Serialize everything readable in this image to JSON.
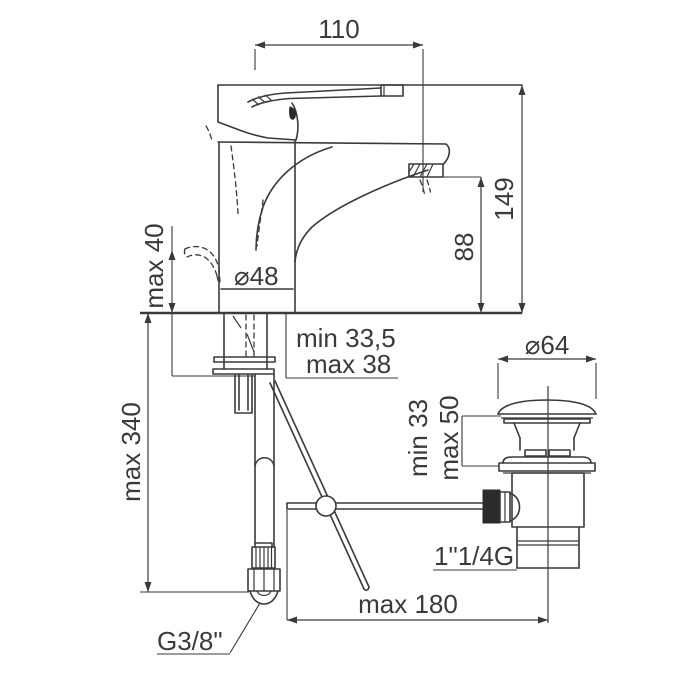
{
  "drawing": {
    "title": "single-lever basin mixer with pop-up waste - dimensional drawing",
    "background_color": "#ffffff",
    "line_color": "#3a3a3a"
  },
  "labels": {
    "spout_reach": "110",
    "overall_height": "149",
    "outlet_height": "88",
    "lever_height": "max 40",
    "body_diameter": "⌀48",
    "deck_min": "min 33,5",
    "deck_max": "max 38",
    "hose_length": "max 340",
    "waste_cap_diameter": "⌀64",
    "waste_min": "min 33",
    "waste_max": "max 50",
    "waste_thread": "1\"1/4G",
    "rod_reach": "max 180",
    "inlet_thread": "G3/8\""
  }
}
